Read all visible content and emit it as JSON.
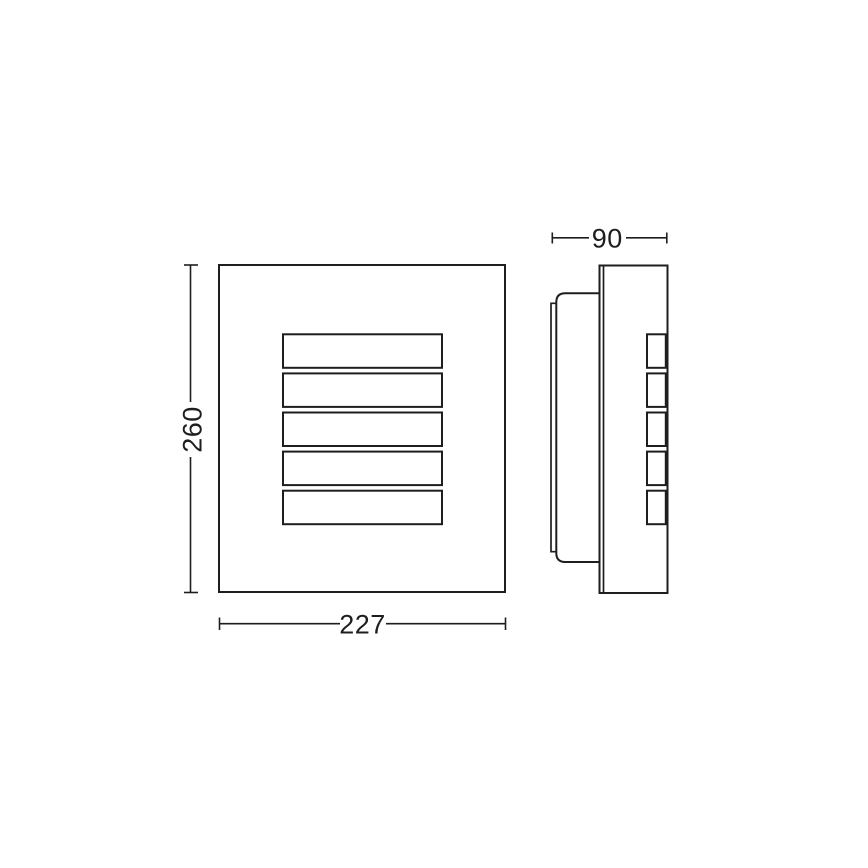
{
  "drawing": {
    "type": "technical-dimension-drawing",
    "colors": {
      "line": "#1e1e1e",
      "background": "#ffffff"
    },
    "dimensions": {
      "height": {
        "value": "260"
      },
      "width": {
        "value": "227"
      },
      "depth": {
        "value": "90"
      }
    }
  }
}
